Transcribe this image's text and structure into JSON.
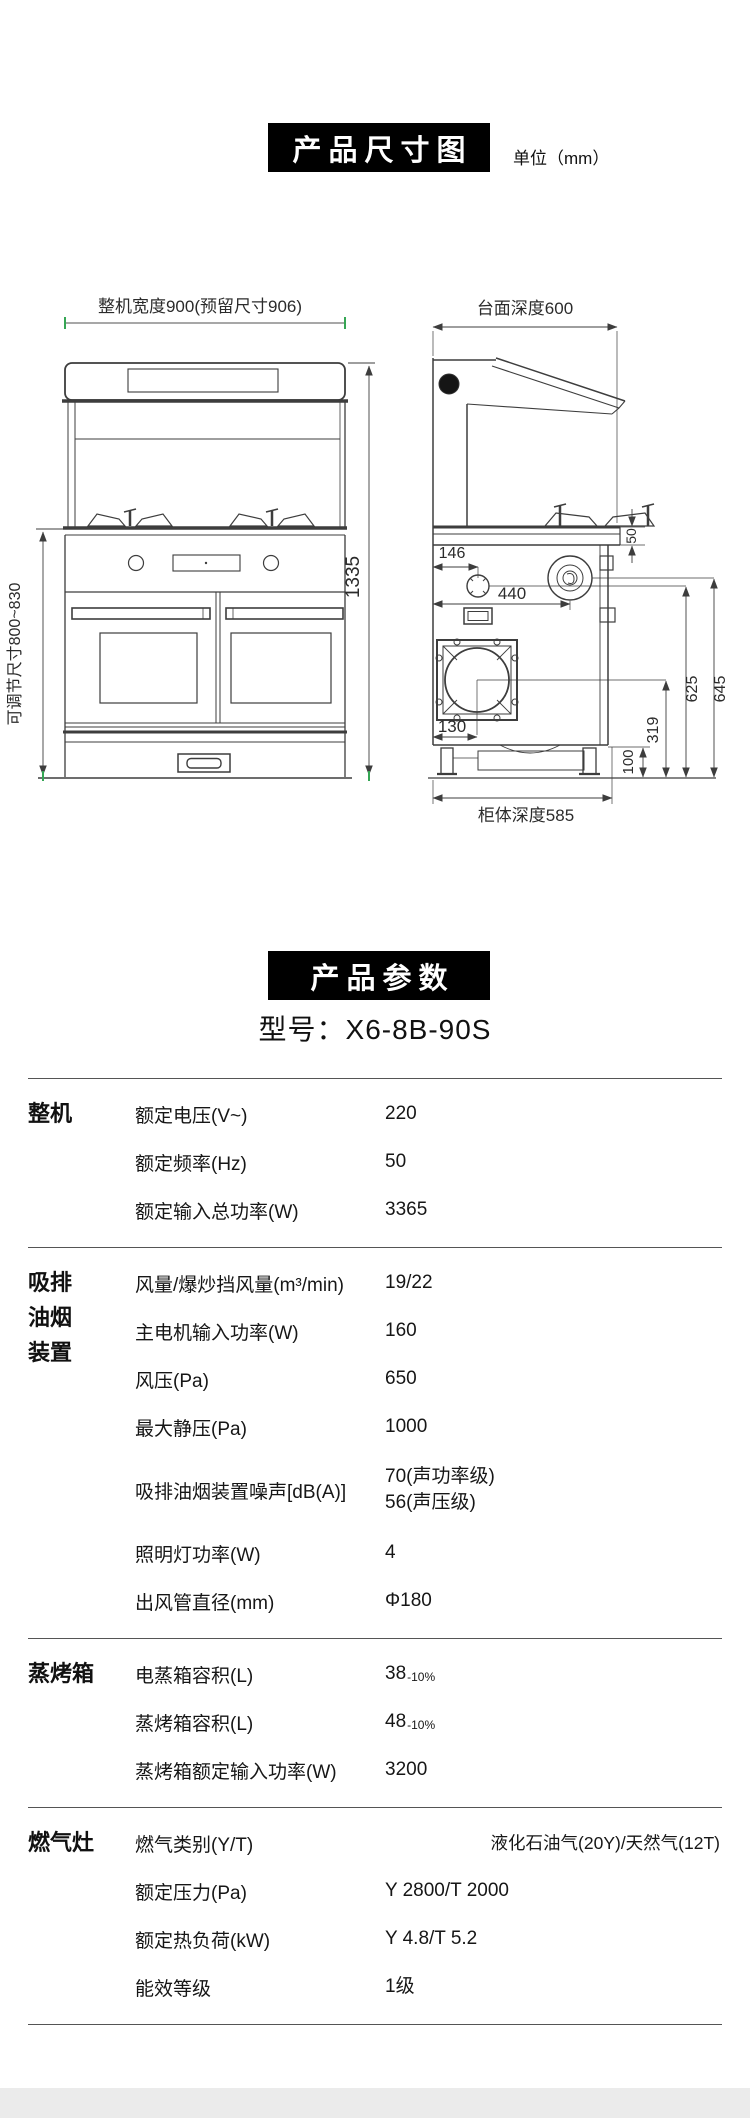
{
  "colors": {
    "header_bg": "#000000",
    "header_text": "#ffffff",
    "body_text": "#1a1a1a",
    "table_line": "#555555",
    "drawing_line": "#3d3d3d",
    "green_tick": "#35a654",
    "footer_bar": "#ebebeb"
  },
  "dimension_section": {
    "header": "产品尺寸图",
    "unit": "单位（mm）",
    "front_view": {
      "width_label": "整机宽度900(预留尺寸906)",
      "height_label": "1335",
      "adjustable_label": "可调节尺寸800~830"
    },
    "side_view": {
      "top_label": "台面深度600",
      "d50": "50",
      "d146": "146",
      "d440": "440",
      "d130": "130",
      "d319": "319",
      "d100": "100",
      "d625": "625",
      "d645": "645",
      "bottom_label": "柜体深度585"
    }
  },
  "params_section": {
    "header": "产品参数",
    "model": "型号：X6-8B-90S",
    "groups": [
      {
        "category": "整机",
        "category_lines": [
          "整机"
        ],
        "rows": [
          {
            "name": "额定电压(V~)",
            "value": "220"
          },
          {
            "name": "额定频率(Hz)",
            "value": "50"
          },
          {
            "name": "额定输入总功率(W)",
            "value": "3365"
          }
        ]
      },
      {
        "category": "吸排油烟装置",
        "category_lines": [
          "吸排",
          "油烟",
          "装置"
        ],
        "rows": [
          {
            "name": "风量/爆炒挡风量(m³/min)",
            "value": "19/22"
          },
          {
            "name": "主电机输入功率(W)",
            "value": "160"
          },
          {
            "name": "风压(Pa)",
            "value": "650"
          },
          {
            "name": "最大静压(Pa)",
            "value": "1000"
          },
          {
            "name": "吸排油烟装置噪声[dB(A)]",
            "value_lines": [
              "70(声功率级)",
              "56(声压级)"
            ]
          },
          {
            "name": "照明灯功率(W)",
            "value": "4"
          },
          {
            "name": "出风管直径(mm)",
            "value": "Φ180"
          }
        ]
      },
      {
        "category": "蒸烤箱",
        "category_lines": [
          "蒸烤箱"
        ],
        "rows": [
          {
            "name": "电蒸箱容积(L)",
            "value_main": "38",
            "value_sub": "-10%"
          },
          {
            "name": "蒸烤箱容积(L)",
            "value_main": "48",
            "value_sub": "-10%"
          },
          {
            "name": "蒸烤箱额定输入功率(W)",
            "value": "3200"
          }
        ]
      },
      {
        "category": "燃气灶",
        "category_lines": [
          "燃气灶"
        ],
        "rows": [
          {
            "name": "燃气类别(Y/T)",
            "value": "液化石油气(20Y)/天然气(12T)"
          },
          {
            "name": "额定压力(Pa)",
            "value": "Y 2800/T 2000"
          },
          {
            "name": "额定热负荷(kW)",
            "value": "Y 4.8/T 5.2"
          },
          {
            "name": "能效等级",
            "value": "1级"
          }
        ]
      }
    ]
  }
}
